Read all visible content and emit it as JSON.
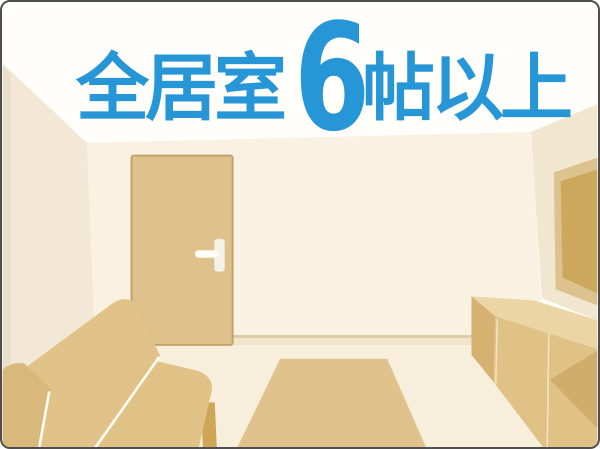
{
  "headline": {
    "prefix": "全居室",
    "number": "6",
    "suffix": "帖以上",
    "full_text": "全居室 6 帖以上",
    "text_color": "#2796d6"
  },
  "scene": {
    "items": [
      "ceiling",
      "left-wall",
      "back-wall",
      "right-wall",
      "floor",
      "door",
      "door-handle",
      "wall-panel",
      "tv-board-cabinet",
      "rug",
      "sofa"
    ],
    "palette": {
      "ceiling": "#fffefa",
      "left_wall": "#f2e8d5",
      "back_wall": "#f9f2e2",
      "right_wall": "#f1e7d1",
      "floor": "#f7eedb",
      "skirting": "#dbcca9",
      "door": "#dfc28b",
      "door_outline": "#c1a26a",
      "sofa": "#e1c389",
      "sofa_arm": "#d8b97b",
      "sofa_leg": "#cfa557",
      "rug": "#e0c38c",
      "cabinet_top": "#ecd5a5",
      "cabinet_front": "#e1c286",
      "cabinet_side": "#d5b272",
      "panel_frame": "#dbc28e",
      "panel_inner": "#cda85c",
      "frame_border": "#4f4f4f"
    }
  }
}
